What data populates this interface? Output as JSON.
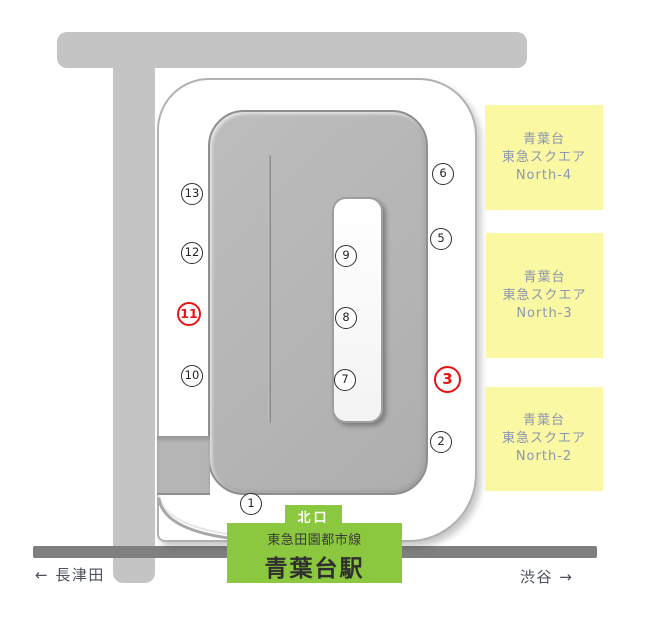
{
  "station_box": {
    "exit": "北口",
    "line": "東急田園都市線",
    "station": "青葉台駅"
  },
  "directions": {
    "west": "← 長津田",
    "east": "渋谷 →"
  },
  "buildings": [
    {
      "lines": [
        "青葉台",
        "東急スクエア",
        "North-4"
      ]
    },
    {
      "lines": [
        "青葉台",
        "東急スクエア",
        "North-3"
      ]
    },
    {
      "lines": [
        "青葉台",
        "東急スクエア",
        "North-2"
      ]
    }
  ],
  "stops": [
    {
      "label": "1",
      "red": false
    },
    {
      "label": "2",
      "red": false
    },
    {
      "label": "3",
      "red": true
    },
    {
      "label": "5",
      "red": false
    },
    {
      "label": "6",
      "red": false
    },
    {
      "label": "7",
      "red": false
    },
    {
      "label": "8",
      "red": false
    },
    {
      "label": "9",
      "red": false
    },
    {
      "label": "10",
      "red": false
    },
    {
      "label": "11",
      "red": true
    },
    {
      "label": "12",
      "red": false
    },
    {
      "label": "13",
      "red": false
    }
  ],
  "colors": {
    "road_gray": "#C4C4C4",
    "island_gray": "#B5B5B5",
    "railway_gray": "#7F7F7F",
    "building_yellow": "#FAF8A2",
    "building_text": "#8C96B0",
    "station_green": "#8CC83F",
    "stop_red": "#E81313"
  }
}
